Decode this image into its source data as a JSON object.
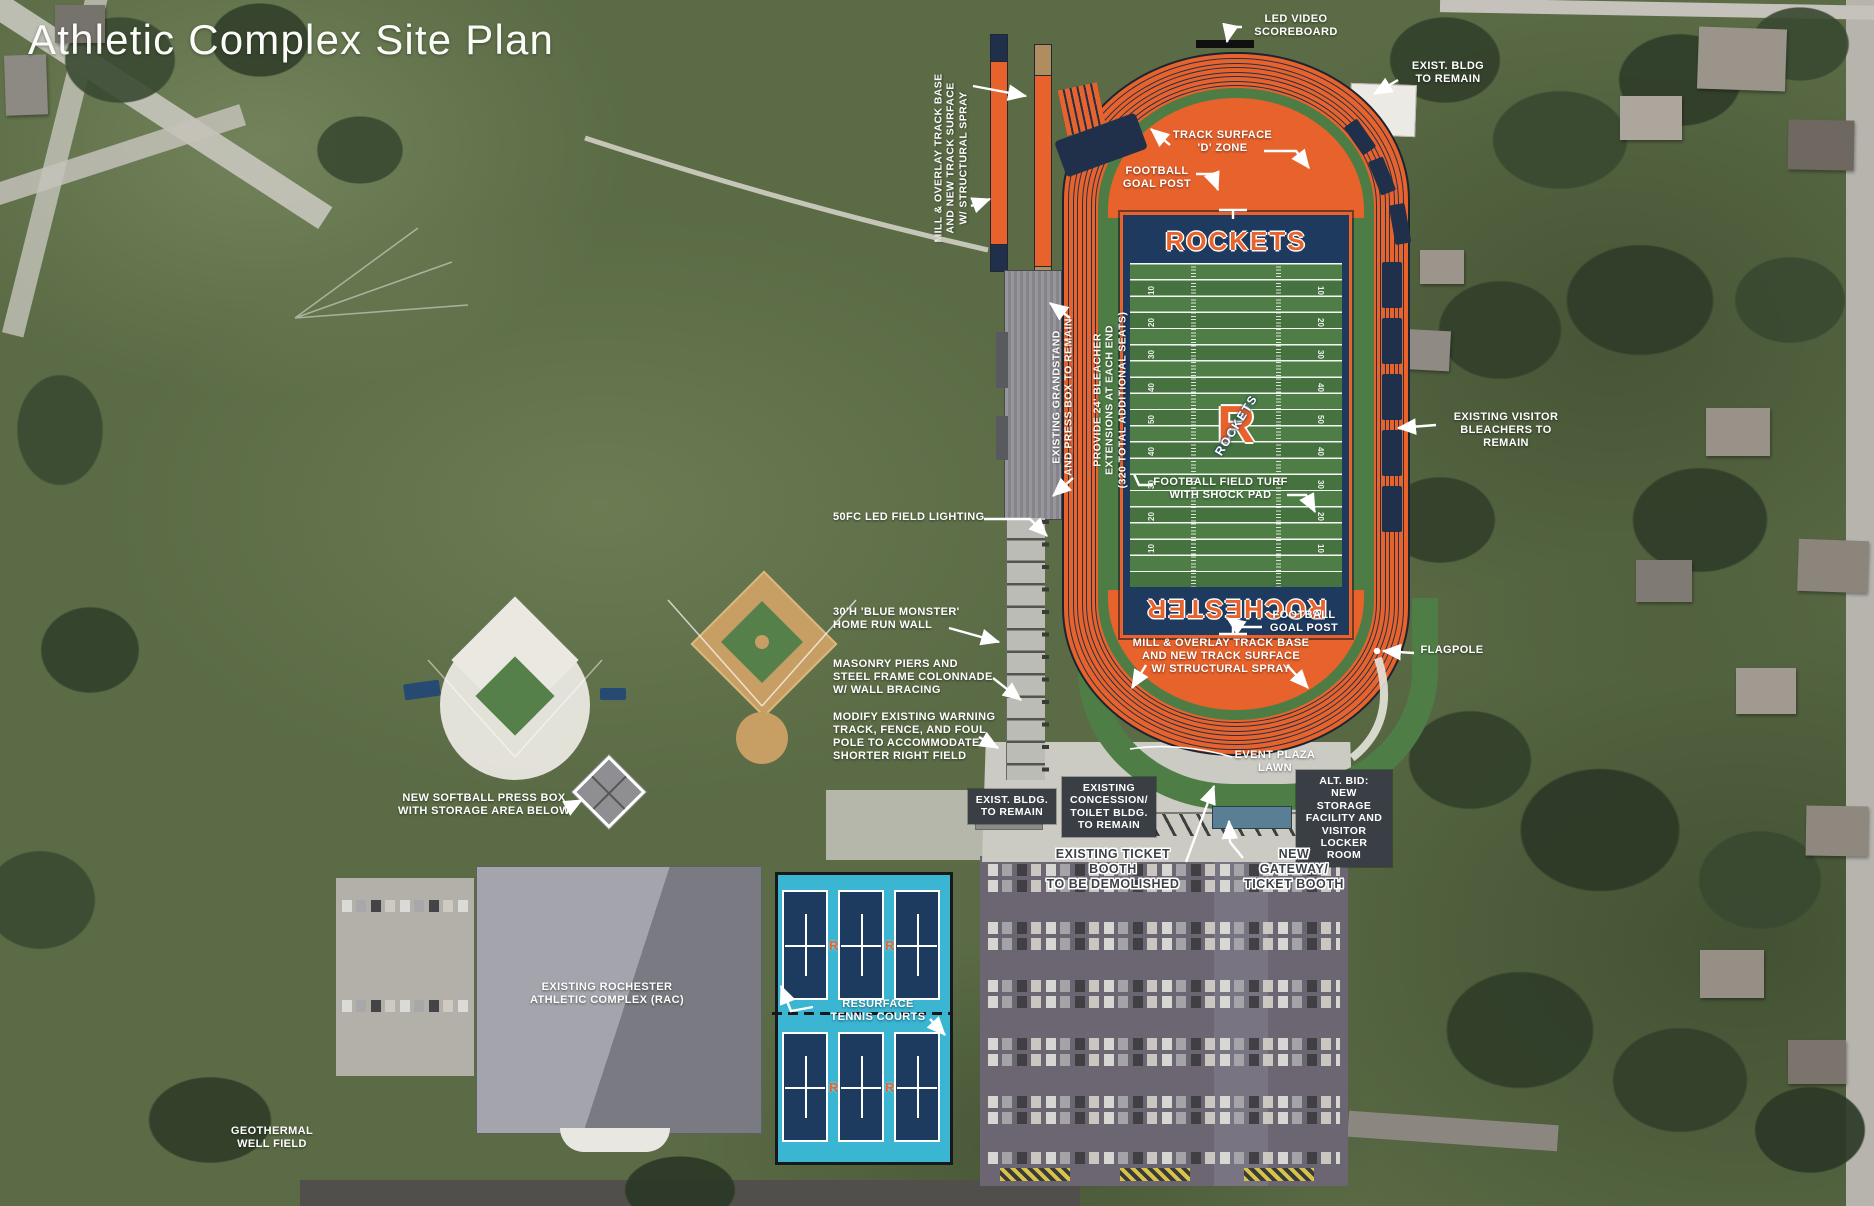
{
  "title": "Athletic Complex Site Plan",
  "stadium": {
    "end_zone_top": "ROCKETS",
    "end_zone_bottom": "ROCHESTER",
    "logo_letter": "R",
    "logo_text": "ROCKETS",
    "yard_numbers": [
      "10",
      "20",
      "30",
      "40",
      "50",
      "40",
      "30",
      "20",
      "10"
    ],
    "tennis_marker": "R"
  },
  "annotations": {
    "led_scoreboard": {
      "text": "LED VIDEO\nSCOREBOARD"
    },
    "exist_bldg_top": {
      "text": "EXIST. BLDG\nTO REMAIN"
    },
    "track_d_zone": {
      "text": "TRACK SURFACE\n'D' ZONE"
    },
    "goal_post_top": {
      "text": "FOOTBALL\nGOAL POST"
    },
    "mill_overlay_left": {
      "text": "MILL & OVERLAY TRACK BASE\nAND NEW TRACK SURFACE\nW/ STRUCTURAL SPRAY"
    },
    "grandstand": {
      "text": "EXISTING GRANDSTAND\nAND PRESS BOX TO REMAIN"
    },
    "bleacher_ext": {
      "text": "PROVIDE 24' BLEACHER\nEXTENSIONS AT EACH END\n(320 TOTAL ADDITIONAL SEATS)"
    },
    "visitor_bleachers": {
      "text": "EXISTING VISITOR\nBLEACHERS TO REMAIN"
    },
    "field_turf": {
      "text": "FOOTBALL FIELD TURF\nWITH SHOCK PAD"
    },
    "field_lighting": {
      "text": "50FC LED FIELD LIGHTING"
    },
    "blue_monster": {
      "text": "30'H 'BLUE MONSTER'\nHOME RUN WALL"
    },
    "masonry": {
      "text": "MASONRY PIERS AND\nSTEEL FRAME COLONNADE\nW/ WALL BRACING"
    },
    "modify_warning": {
      "text": "MODIFY EXISTING WARNING\nTRACK, FENCE, AND FOUL\nPOLE TO ACCOMMODATE\nSHORTER RIGHT FIELD"
    },
    "goal_post_bottom": {
      "text": "FOOTBALL\nGOAL POST"
    },
    "mill_overlay_bottom": {
      "text": "MILL & OVERLAY TRACK BASE\nAND NEW TRACK SURFACE\nW/ STRUCTURAL SPRAY"
    },
    "flagpole": {
      "text": "FLAGPOLE"
    },
    "event_plaza_lawn": {
      "text": "EVENT PLAZA\nLAWN"
    },
    "exist_bldg_plaza": {
      "text": "EXIST. BLDG.\nTO REMAIN"
    },
    "concession": {
      "text": "EXISTING\nCONCESSION/\nTOILET BLDG.\nTO REMAIN"
    },
    "alt_bid": {
      "text": "ALT. BID:\nNEW STORAGE\nFACILITY AND\nVISITOR\nLOCKER ROOM"
    },
    "ticket_demolish": {
      "text": "EXISTING TICKET BOOTH\nTO BE DEMOLISHED"
    },
    "new_gateway": {
      "text": "NEW GATEWAY/\nTICKET BOOTH"
    },
    "softball_pressbox": {
      "text": "NEW SOFTBALL PRESS BOX\nWITH STORAGE AREA BELOW"
    },
    "rac": {
      "text": "EXISTING ROCHESTER\nATHLETIC COMPLEX (RAC)"
    },
    "tennis": {
      "text": "RESURFACE\nTENNIS COURTS"
    },
    "geothermal": {
      "text": "GEOTHERMAL\nWELL FIELD"
    }
  },
  "colors": {
    "accent_orange": "#E8622C",
    "navy": "#1E3A5E",
    "field_green": "#4D7C45",
    "tennis_cyan": "#3AB5D2",
    "label_box_gray": "#3A3F45",
    "label_white": "#FFFFFF"
  }
}
